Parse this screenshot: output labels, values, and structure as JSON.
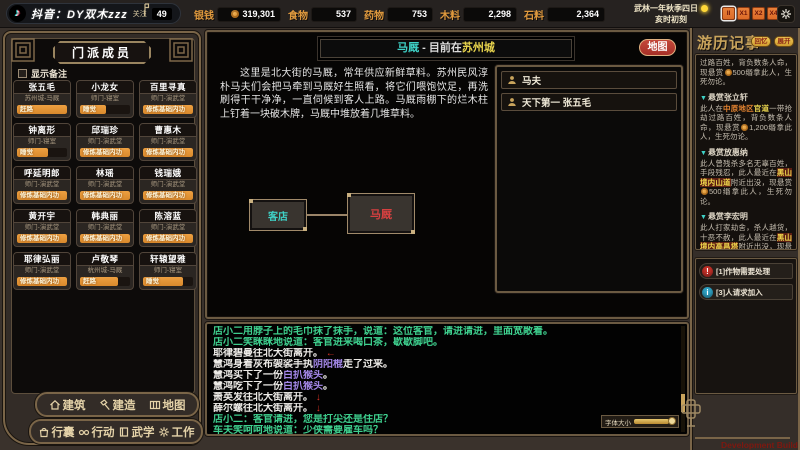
{
  "colors": {
    "gold": "#c9a45c",
    "frame": "#7a6548",
    "bar-orange": "#d9892c",
    "res-label": "#e09a3e",
    "cyan": "#3fd2c7",
    "yellow": "#e8d44d",
    "map-red": "#a63028",
    "node-red": "#d64040",
    "chat-green": "#3ecf8e",
    "chat-purple": "#a488e8",
    "arrow-red": "#d83226",
    "speed-orange": "#dd6b28",
    "dev-red": "#7e1810"
  },
  "stream": {
    "platform": "抖音：DY双木zzz",
    "follow_label": "关注",
    "follow_count": "49"
  },
  "topbar": {
    "resources": [
      {
        "label": "银钱",
        "value": "319,301",
        "coin": true
      },
      {
        "label": "食物",
        "value": "537"
      },
      {
        "label": "药物",
        "value": "753"
      },
      {
        "label": "木料",
        "value": "2,298"
      },
      {
        "label": "石料",
        "value": "2,364"
      }
    ],
    "date_line1": "武林一年秋季四日",
    "date_line2": "亥时初刻",
    "speed_buttons": [
      {
        "label": "II",
        "active": true
      },
      {
        "label": "X1",
        "active": false
      },
      {
        "label": "X2",
        "active": false
      },
      {
        "label": "X4",
        "active": false
      },
      {
        "label": "X6",
        "active": false
      }
    ]
  },
  "sect": {
    "title": "门派成员",
    "show_notes_label": "显示备注",
    "members": [
      {
        "name": "张五毛",
        "location": "苏州城-马厩",
        "action": "赶路",
        "progress": 100
      },
      {
        "name": "小龙女",
        "location": "师门-寝室",
        "action": "睡觉",
        "progress": 52
      },
      {
        "name": "百里寻真",
        "location": "师门-演武堂",
        "action": "修炼基础内功",
        "progress": 100
      },
      {
        "name": "钟离形",
        "location": "师门-寝室",
        "action": "睡觉",
        "progress": 62
      },
      {
        "name": "邱瑞珍",
        "location": "师门-演武堂",
        "action": "修炼基础内功",
        "progress": 100
      },
      {
        "name": "曹惠木",
        "location": "师门-演武堂",
        "action": "修炼基础内功",
        "progress": 100
      },
      {
        "name": "呼延明郎",
        "location": "师门-演武堂",
        "action": "修炼基础内功",
        "progress": 100
      },
      {
        "name": "林瑶",
        "location": "师门-演武堂",
        "action": "修炼基础内功",
        "progress": 100
      },
      {
        "name": "钱瑞娥",
        "location": "师门-演武堂",
        "action": "修炼基础内功",
        "progress": 100
      },
      {
        "name": "黄开宇",
        "location": "师门-演武堂",
        "action": "修炼基础内功",
        "progress": 100
      },
      {
        "name": "韩典丽",
        "location": "师门-演武堂",
        "action": "修炼基础内功",
        "progress": 100
      },
      {
        "name": "陈溶蓝",
        "location": "师门-演武堂",
        "action": "修炼基础内功",
        "progress": 100
      },
      {
        "name": "耶律弘丽",
        "location": "师门-演武堂",
        "action": "修炼基础内功",
        "progress": 100
      },
      {
        "name": "卢敬琴",
        "location": "杭州城-马厩",
        "action": "赶路",
        "progress": 76
      },
      {
        "name": "轩辕望雅",
        "location": "师门-寝室",
        "action": "睡觉",
        "progress": 80
      }
    ]
  },
  "location": {
    "title_name": "马厩",
    "title_sep": " - ",
    "title_prefix": "目前在",
    "title_city": "苏州城",
    "map_button": "地图",
    "description": "这里是北大街的马厩，常年供应新鲜草料。苏州民风淳朴马夫们会把马牵到马厩好生照看，将它们喂饱饮足，再洗刷得干干净净，一直伺候到客人上路。马厩雨棚下的烂木柱上钉着一块破木牌，马厩中堆放着几堆草料。",
    "nodes": [
      {
        "label": "客店",
        "current": false
      },
      {
        "label": "马厩",
        "current": true
      }
    ],
    "people": [
      {
        "label": "马夫"
      },
      {
        "label": "天下第一  张五毛"
      }
    ]
  },
  "journal": {
    "title": "游历记事",
    "buttons": [
      "回忆",
      "展开"
    ],
    "entries": [
      {
        "header": "",
        "body": [
          {
            "t": "过路百姓，背负数条人命，现悬赏",
            "c": "plain"
          },
          {
            "c": "coin"
          },
          {
            "t": "500缗拿此人，生死勿论。",
            "c": "plain"
          }
        ]
      },
      {
        "header": "悬赏张立轩",
        "body": [
          {
            "t": "此人在",
            "c": "plain"
          },
          {
            "t": "中原地区",
            "c": "area"
          },
          {
            "t": "官道",
            "c": "road"
          },
          {
            "t": "一带抢劫过路百姓，背负数条人命，现悬赏",
            "c": "plain"
          },
          {
            "c": "coin"
          },
          {
            "t": "1,200缗拿此人，生死勿论。",
            "c": "plain"
          }
        ]
      },
      {
        "header": "悬赏放惠纳",
        "body": [
          {
            "t": "此人曾残杀多名无辜百姓，手段残忍，此人最近在",
            "c": "plain"
          },
          {
            "t": "黑山境内山道",
            "c": "loc"
          },
          {
            "t": "附近出没，现悬赏",
            "c": "plain"
          },
          {
            "c": "coin"
          },
          {
            "t": "500缗拿此人，生死勿论。",
            "c": "plain"
          }
        ]
      },
      {
        "header": "悬赏李宏明",
        "body": [
          {
            "t": "此人打家劫舍，杀人越货，十恶不赦，此人最近在",
            "c": "plain"
          },
          {
            "t": "黑山境内高昌塔",
            "c": "loc"
          },
          {
            "t": "附近出没，现悬赏",
            "c": "plain"
          },
          {
            "c": "coin"
          },
          {
            "t": "800缗拿此人，生死勿论。",
            "c": "plain"
          }
        ]
      },
      {
        "header": "悬赏惠吉词",
        "body": [
          {
            "t": "此人在",
            "c": "plain"
          },
          {
            "t": "中原地区",
            "c": "area"
          },
          {
            "t": "官道",
            "c": "road"
          },
          {
            "t": "一带抢劫过路百姓，背负数条人命，现悬赏",
            "c": "plain"
          },
          {
            "c": "coin"
          },
          {
            "t": "800缗拿此人，生死勿论。",
            "c": "plain"
          }
        ]
      }
    ]
  },
  "notifications": [
    {
      "icon": "alert",
      "glyph": "!",
      "text": "[1]作物需要处理"
    },
    {
      "icon": "info",
      "glyph": "i",
      "text": "[3]人请求加入"
    }
  ],
  "chat": {
    "font_size_label": "字体大小",
    "lines": [
      [
        {
          "t": "店小二用脖子上的毛巾抹了抹手，说道：这位客官，请进请进，里面宽敞着。",
          "c": "npc"
        }
      ],
      [
        {
          "t": "店小二笑眯眯地说道：客官进来喝口茶，歇歇脚吧。",
          "c": "npc"
        }
      ],
      [
        {
          "t": "耶律碧曼往北大街离开。",
          "c": "plain"
        },
        {
          "t": " ←",
          "c": "arrow"
        }
      ],
      [
        {
          "t": "慧鸿身着灰布袈裟手执",
          "c": "plain"
        },
        {
          "t": "阴阳棍",
          "c": "item"
        },
        {
          "t": "走了过来。",
          "c": "plain"
        }
      ],
      [
        {
          "t": "慧鸿买下了一份",
          "c": "plain"
        },
        {
          "t": "白扒猴头",
          "c": "item"
        },
        {
          "t": "。",
          "c": "plain"
        }
      ],
      [
        {
          "t": "慧鸿吃下了一份",
          "c": "plain"
        },
        {
          "t": "白扒猴头",
          "c": "item"
        },
        {
          "t": "。",
          "c": "plain"
        }
      ],
      [
        {
          "t": "萧英发往北大街离开。",
          "c": "plain"
        },
        {
          "t": " ↓",
          "c": "arrow"
        }
      ],
      [
        {
          "t": "薛尔螺往北大街离开。",
          "c": "plain"
        },
        {
          "t": " ↓",
          "c": "arrow"
        }
      ],
      [
        {
          "t": "店小二：客官请进，您是打尖还是住店？",
          "c": "npc"
        }
      ],
      [
        {
          "t": "车夫笑呵呵地说道：少侠需要雇车吗？",
          "c": "npc"
        }
      ]
    ]
  },
  "bottom_menu": {
    "row1": [
      {
        "icon": "house-icon",
        "label": "建筑"
      },
      {
        "icon": "hammer-icon",
        "label": "建造"
      },
      {
        "icon": "map-icon",
        "label": "地图"
      }
    ],
    "row2": [
      {
        "icon": "bag-icon",
        "label": "行囊"
      },
      {
        "icon": "eyes-icon",
        "label": "行动"
      },
      {
        "icon": "book-icon",
        "label": "武学"
      },
      {
        "icon": "gear-icon",
        "label": "工作"
      }
    ]
  },
  "footer": {
    "dev_build": "Development Build"
  }
}
